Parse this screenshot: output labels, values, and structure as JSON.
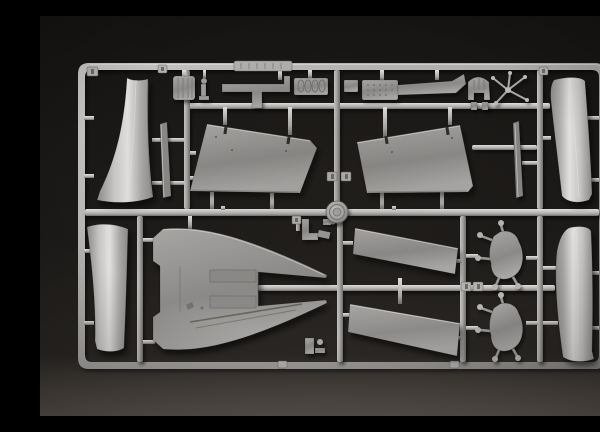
{
  "scene": {
    "type": "photograph",
    "subject": "Injection-molded plastic model kit sprue (runner frame) of light gray styrene aircraft parts on a dark charcoal surface",
    "plastic_material": "light gray styrene",
    "background_surface": "dark charcoal, brightening toward the bottom edge",
    "no_visible_text": "part-number tabs and brand plate are present but illegible at this scale"
  },
  "palette": {
    "bg_top": "#171513",
    "bg_mid": "#1c1a18",
    "bg_low": "#2a2724",
    "bg_bottom": "#46413c",
    "plastic_hi": "#e2e1df",
    "plastic_light": "#c7c6c4",
    "plastic_mid": "#a9a8a6",
    "plastic_shade": "#8b8a88",
    "plastic_dark": "#6f6e6c",
    "recess": "#2b2927"
  },
  "sprue": {
    "frame": "rounded rectangle runner frame with one horizontal center runner, two sub-runners and seven vertical runners",
    "medallion": "circular embossed logo disc at center runner crossing",
    "brand_plate": "ribbed rectangular plate on top runner",
    "part_number_tabs": 9,
    "parts": [
      {
        "id": "intake-duct-top-left",
        "desc": "tall curved duct half, flared foot"
      },
      {
        "id": "strake-strip-top-left",
        "desc": "thin edge-on strip"
      },
      {
        "id": "ribbed-drum",
        "desc": "small ribbed drum"
      },
      {
        "id": "figurine-linkage",
        "desc": "tiny standing linkage part"
      },
      {
        "id": "t-bracket-arm",
        "desc": "flat T-shaped bracket"
      },
      {
        "id": "coiled-hose-block",
        "desc": "small block with coil texture"
      },
      {
        "id": "small-block",
        "desc": "small rectangular block"
      },
      {
        "id": "textured-arm",
        "desc": "stippled block with long tapered arm"
      },
      {
        "id": "arched-bracket",
        "desc": "horseshoe-arched ribbed bracket"
      },
      {
        "id": "rod-cluster",
        "desc": "cluster of tiny rods"
      },
      {
        "id": "wing-panel-top-left",
        "desc": "large trapezoidal wing panel, slotted edge"
      },
      {
        "id": "wing-panel-top-right",
        "desc": "mirrored trapezoidal wing panel"
      },
      {
        "id": "strake-strip-top-right",
        "desc": "thin edge-on strip"
      },
      {
        "id": "intake-duct-top-right",
        "desc": "tall curved duct half"
      },
      {
        "id": "intake-duct-bottom-left",
        "desc": "tall curved duct half"
      },
      {
        "id": "rear-fuselage-deck",
        "desc": "large twin-pointed fuselage deck with recessed panels"
      },
      {
        "id": "l-bracket",
        "desc": "small L bracket near center"
      },
      {
        "id": "hook-clip-top",
        "desc": "small clip with pin"
      },
      {
        "id": "hook-clip-bottom",
        "desc": "small clip with pin"
      },
      {
        "id": "flap-panel-upper",
        "desc": "slanted rectangular flap panel"
      },
      {
        "id": "flap-panel-lower",
        "desc": "slanted rectangular flap panel"
      },
      {
        "id": "hatch-cover-upper",
        "desc": "irregular hatch cover with hinge pegs"
      },
      {
        "id": "hatch-cover-lower",
        "desc": "irregular hatch cover with hinge pegs"
      },
      {
        "id": "intake-duct-bottom-right",
        "desc": "tall curved duct half"
      }
    ]
  }
}
